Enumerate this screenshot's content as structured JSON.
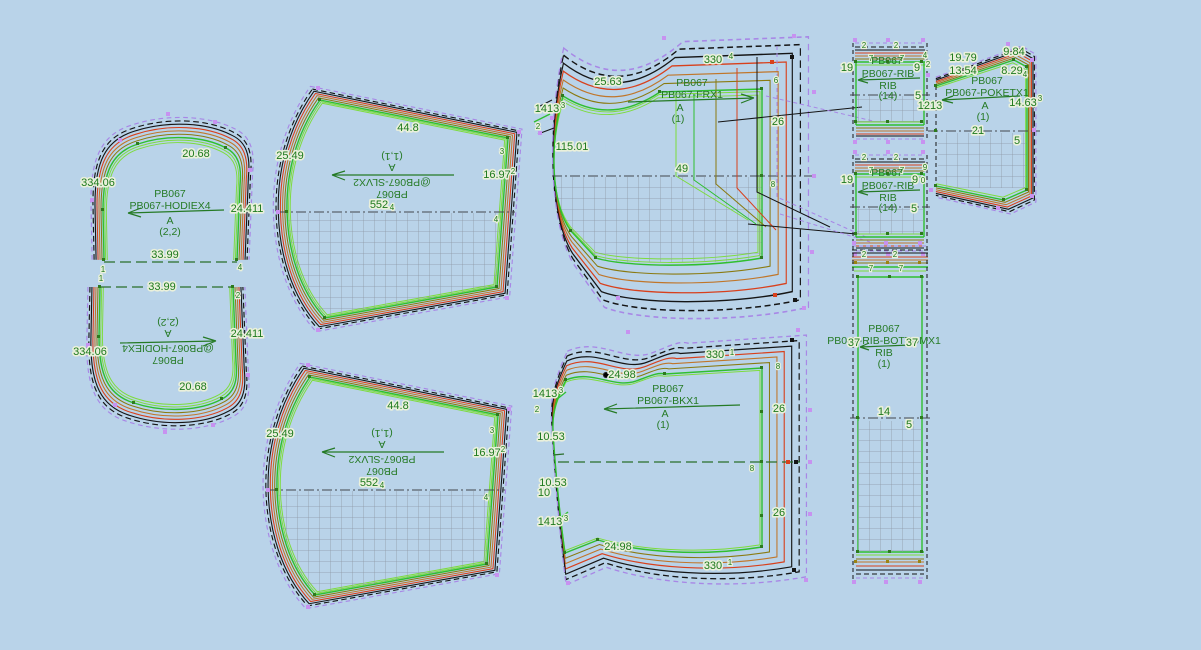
{
  "palette": {
    "background": "#b9d3e9",
    "piece_outline_green": "#2fbf2f",
    "grade_inner_green": "#7ddc3c",
    "grade_olive": "#8a7a10",
    "grade_orange": "#c0762a",
    "grade_red": "#d8401c",
    "grade_black": "#151515",
    "grade_purple": "#a887e6",
    "selected_piece_fill": "#a7a7a7",
    "label_text_green": "#1e7a1e"
  },
  "pieces": {
    "hood_top": {
      "title": "PB067",
      "code": "PB067-HODIEX4",
      "size": "A",
      "qty": "(2,2)",
      "m_arc": "20.68",
      "m_left": "334.06",
      "m_right": "24.411",
      "m_bottom": "33.99",
      "pt_left": "1",
      "pt_right": "4"
    },
    "hood_bottom": {
      "title": "PB067",
      "code": "@PB067-HODIEX4",
      "size": "A",
      "qty": "(2,2)",
      "m_arc": "20.68",
      "m_left": "334.06",
      "m_right": "24.411",
      "m_top": "33.99",
      "pt_left": "1",
      "pt_right": "2"
    },
    "sleeve_top": {
      "title": "PB067",
      "code": "@PB067-SLVX2",
      "size": "A",
      "qty": "(1,1)",
      "m_top": "44.8",
      "m_left": "25.49",
      "m_right": "16.97",
      "m_center": "552",
      "pt_a": "3",
      "pt_b": "4",
      "pt_c": "2",
      "pt_d": "4"
    },
    "sleeve_bottom": {
      "title": "PB067",
      "code": "PB067-SLVX2",
      "size": "A",
      "qty": "(1,1)",
      "m_top": "44.8",
      "m_left": "25.49",
      "m_right": "16.97",
      "m_center": "552",
      "pt_a": "3",
      "pt_b": "4",
      "pt_c": "2",
      "pt_d": "4"
    },
    "front": {
      "title": "PB067",
      "code": "PB067-FRX1",
      "size": "A",
      "qty": "(1)",
      "m_neck": "25.63",
      "m_top": "330",
      "m_notch": "1413",
      "m_armhole": "115.01",
      "m_center": "49",
      "m_side": "26",
      "pt_top": "4",
      "pt_side": "6",
      "pt_mid": "8",
      "pt_notch": "3",
      "pt_notch2": "2"
    },
    "back": {
      "title": "PB067",
      "code": "PB067-BKX1",
      "size": "A",
      "qty": "(1)",
      "m_shoulder": "24.98",
      "m_top": "330",
      "m_bottom": "330",
      "m_notch_top": "1413",
      "m_notch_bottom": "1413",
      "m_left_a": "10.53",
      "m_left_b": "10.53",
      "m_left_c": "10",
      "m_side_top": "26",
      "m_side_bottom": "26",
      "m_hem": "24.98",
      "pt_center": "8",
      "pt_top": "1",
      "pt_bot": "1",
      "pt_shoulder": "8",
      "pt_notch": "3",
      "pt_notch2": "2",
      "pt_notch3": "3"
    },
    "rib_top": {
      "title": "PB067",
      "code": "PB067-RIB",
      "sub": "RIB",
      "qty": "(14)",
      "n2a": "2",
      "n2b": "2",
      "n7a": "7",
      "n7b": "7",
      "n_left": "19",
      "n_right": "9",
      "n5": "5",
      "pt_a": "4",
      "pt_b": "2"
    },
    "rib_mid": {
      "title": "PB067",
      "code": "PB067-RIB",
      "sub": "RIB",
      "qty": "(14)",
      "n2a": "2",
      "n2b": "2",
      "n7a": "7",
      "n7b": "7",
      "n_left": "19",
      "n_right": "9",
      "n5": "5",
      "pt_a": "9",
      "pt_b": "0"
    },
    "poket": {
      "title": "PB067",
      "code": "PB067-POKETX1",
      "size": "A",
      "qty": "(1)",
      "m_a": "19.79",
      "m_b": "9.84",
      "m_c": "13.54",
      "m_d": "8.29",
      "m_left": "1213",
      "m_right": "14.63",
      "m_center": "21",
      "n5": "5",
      "pt_a": "4",
      "pt_b": "3"
    },
    "rib_bottom": {
      "title": "PB067",
      "code": "PB067-RIB-BOTTOMX1",
      "sub": "RIB",
      "qty": "(1)",
      "n37l": "37",
      "n37r": "37",
      "n2a": "2",
      "n2b": "2",
      "n7a": "7",
      "n7b": "7",
      "m_center": "14",
      "n5": "5"
    }
  }
}
